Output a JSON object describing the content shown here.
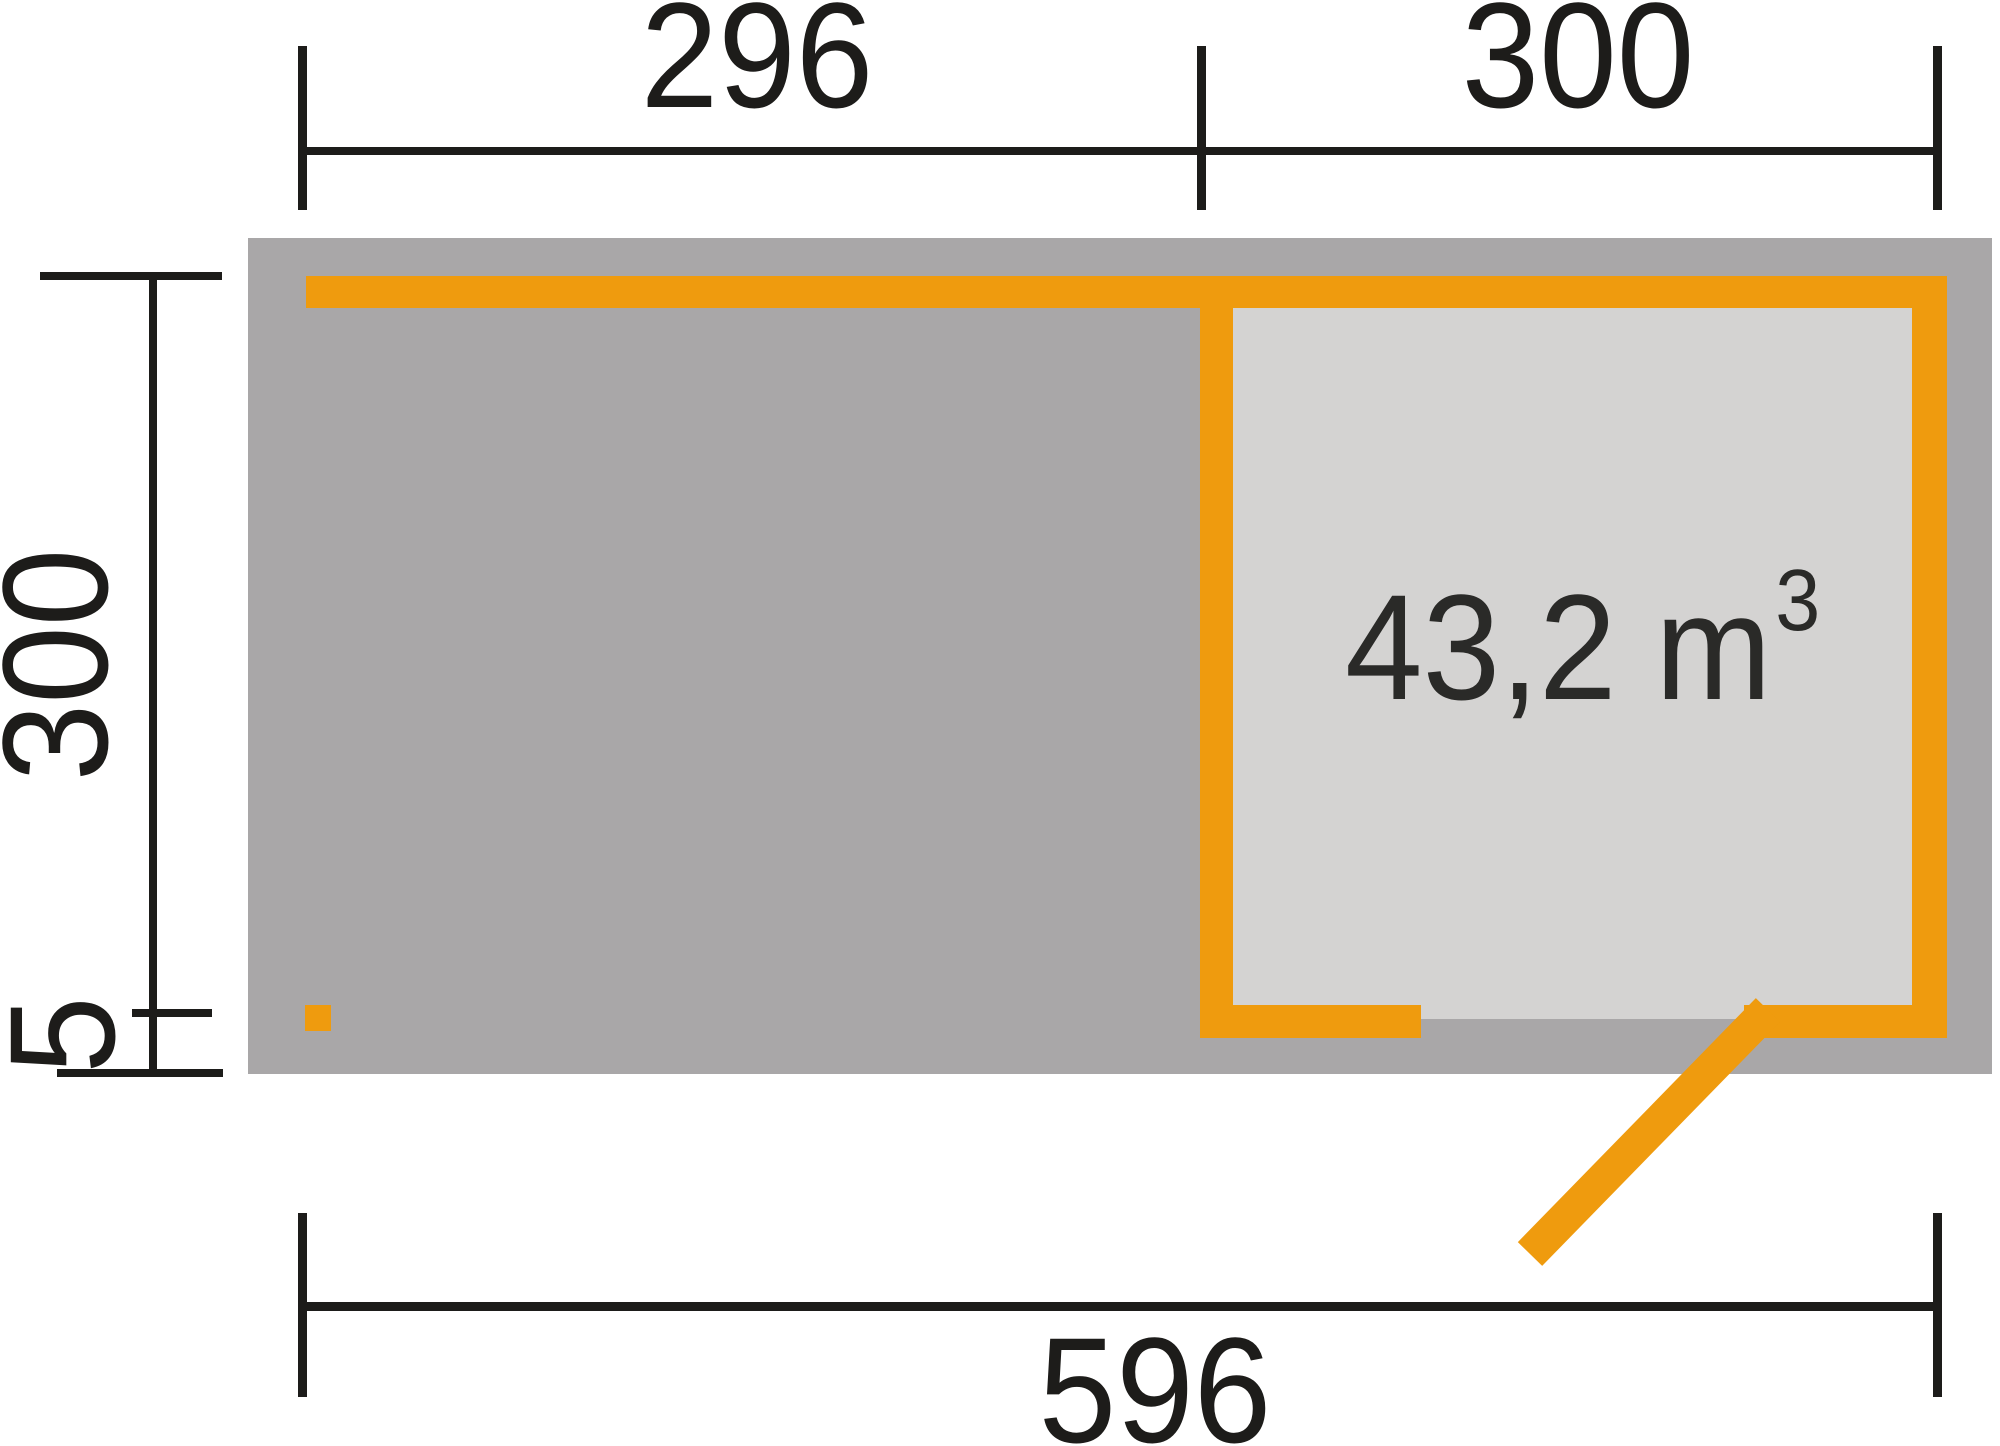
{
  "diagram": {
    "type": "floor-plan",
    "dimensions": {
      "top_left_width": "296",
      "top_right_width": "300",
      "side_depth": "300",
      "side_overhang": "5",
      "total_width": "596"
    },
    "room": {
      "volume_value": "43,2 m",
      "volume_exponent": "3"
    }
  },
  "colors": {
    "orange": "#ef9b0e",
    "slab_gray": "#a9a7a8",
    "interior_gray": "#d4d3d2",
    "line_black": "#1d1c1a",
    "background": "#ffffff"
  }
}
